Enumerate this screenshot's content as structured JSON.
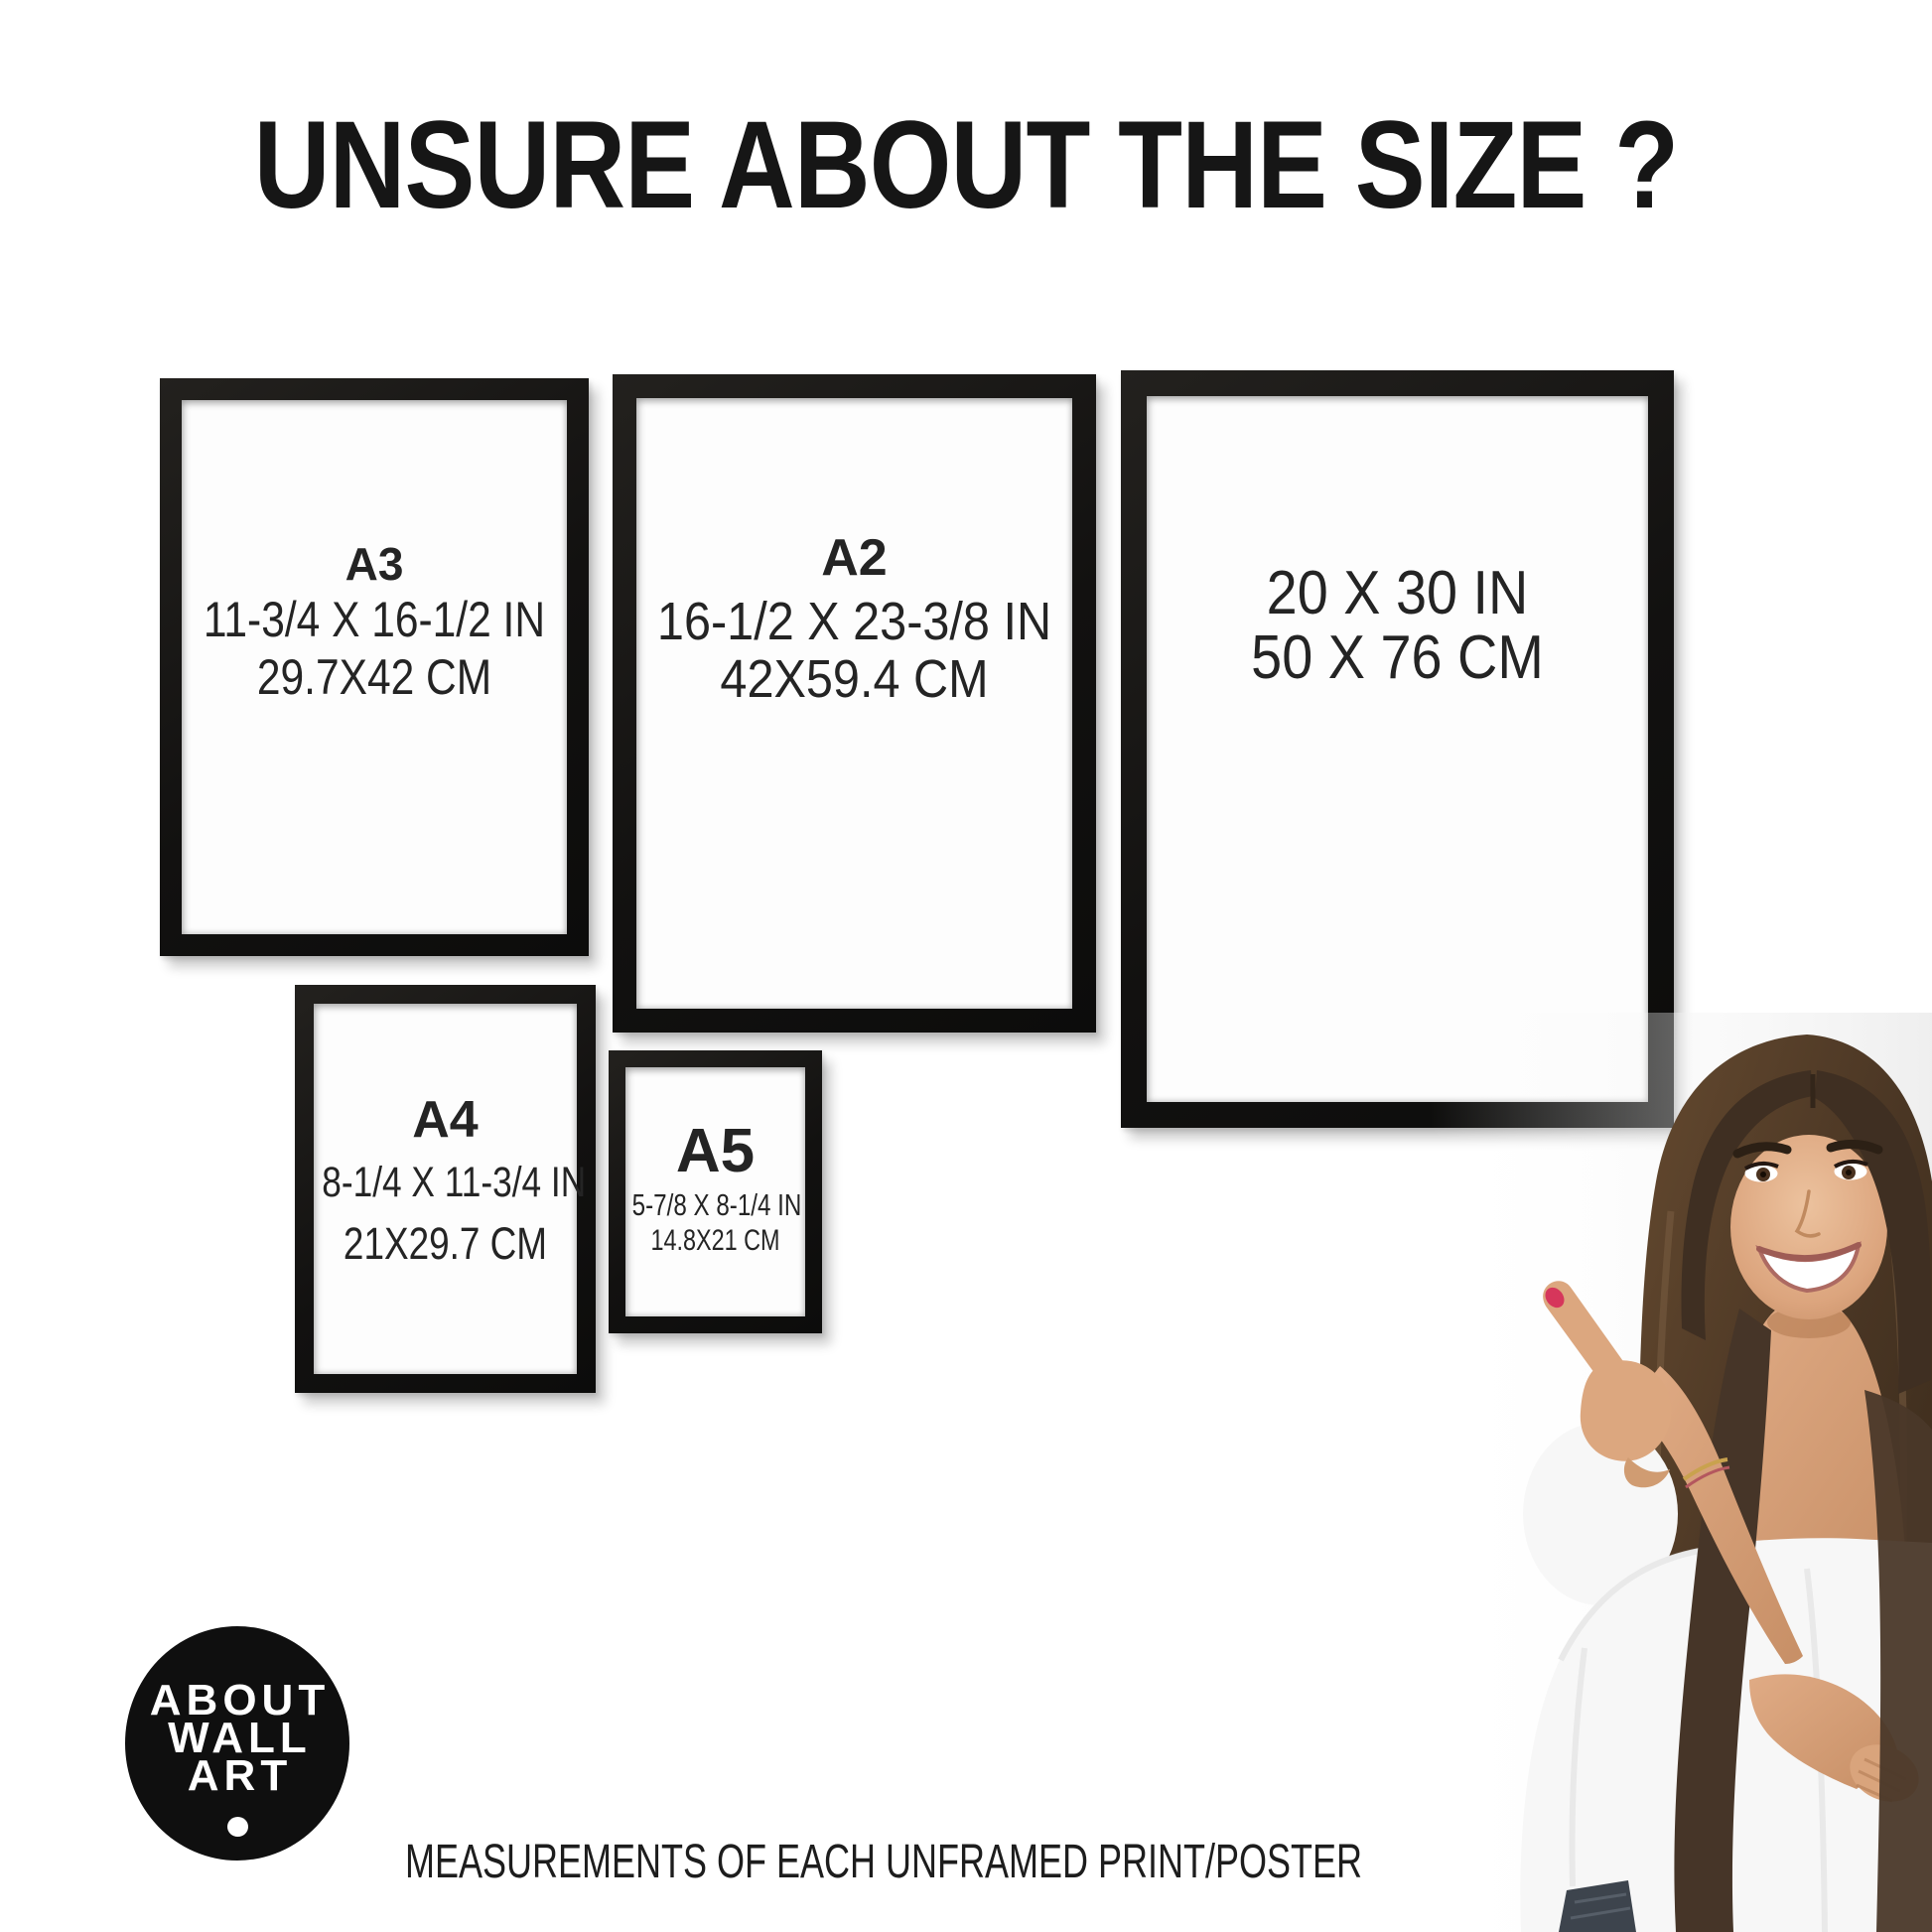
{
  "title": "UNSURE ABOUT THE SIZE ?",
  "frames": [
    {
      "id": "a3",
      "label": "A3",
      "inches": "11-3/4 X 16-1/2 IN",
      "cm": "29.7X42 CM"
    },
    {
      "id": "a2",
      "label": "A2",
      "inches": "16-1/2 X 23-3/8 IN",
      "cm": "42X59.4 CM"
    },
    {
      "id": "20x30",
      "label": "",
      "inches": "20 X 30 IN",
      "cm": "50 X 76 CM"
    },
    {
      "id": "a4",
      "label": "A4",
      "inches": "8-1/4 X 11-3/4 IN",
      "cm": "21X29.7 CM"
    },
    {
      "id": "a5",
      "label": "A5",
      "inches": "5-7/8 X 8-1/4 IN",
      "cm": "14.8X21 CM"
    }
  ],
  "logo": {
    "line1": "ABOUT",
    "line2": "WALL",
    "line3": "ART"
  },
  "caption": "MEASUREMENTS OF EACH UNFRAMED PRINT/POSTER",
  "colors": {
    "frame_black": "#131211",
    "text": "#1e1e1e",
    "logo_bg": "#0f0f0f",
    "nail_red": "#d6365b",
    "hair_brown": "#4a3829",
    "skin": "#d9a988",
    "blouse_white": "#f7f7f7"
  }
}
